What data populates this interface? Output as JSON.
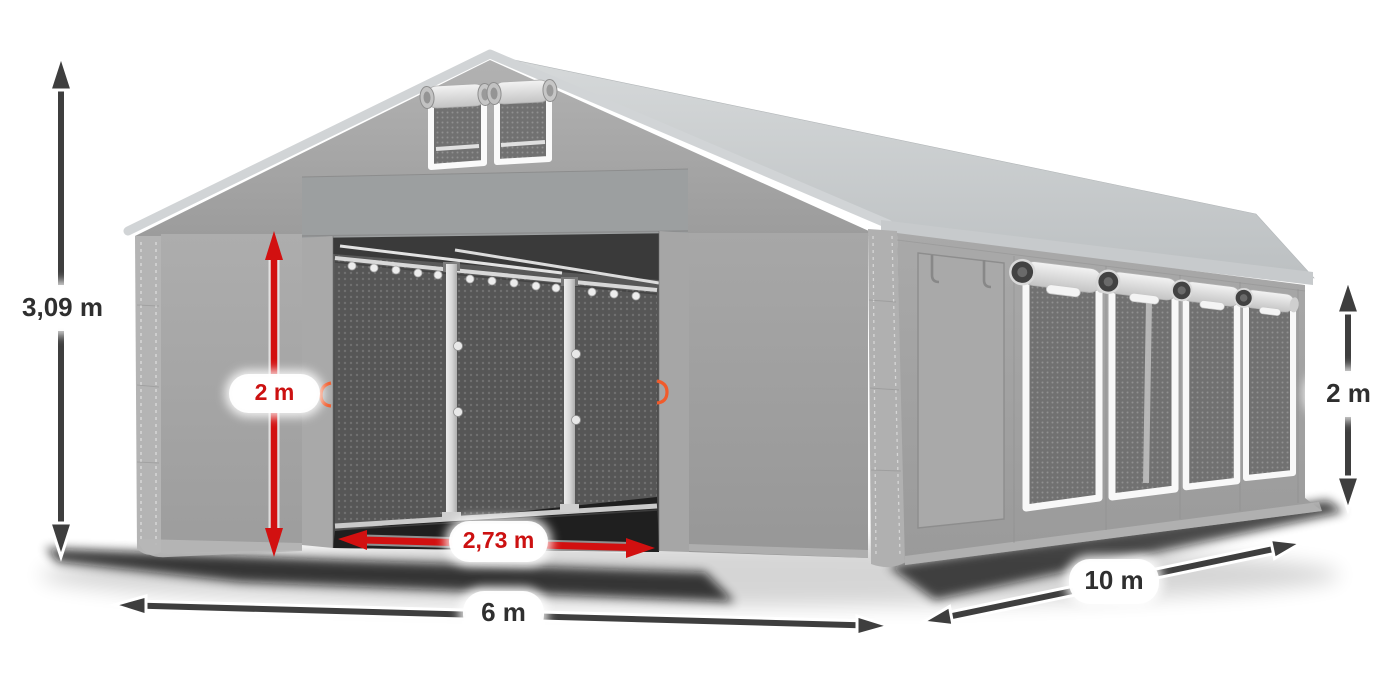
{
  "page": {
    "background": "#ffffff"
  },
  "diagram": {
    "subject": "gray-marquee-tent-dimension-diagram",
    "labels": {
      "total_height": {
        "text": "3,09 m",
        "color": "#2f2f2f"
      },
      "entrance_height": {
        "text": "2 m",
        "color": "#cc1111"
      },
      "entrance_width": {
        "text": "2,73 m",
        "color": "#cc1111"
      },
      "front_width": {
        "text": "6 m",
        "color": "#2f2f2f"
      },
      "side_length": {
        "text": "10 m",
        "color": "#2f2f2f"
      },
      "side_wall_height": {
        "text": "2 m",
        "color": "#2f2f2f"
      }
    },
    "arrow_colors": {
      "dark": "#3e3e3e",
      "red": "#d21010"
    },
    "label_style": {
      "background": "#ffffff"
    },
    "tent_colors": {
      "roof": "#c9cccd",
      "walls": "#a3a3a3",
      "interior": "#4f4f4f",
      "mesh": "#6f6f6f",
      "frame_trim": "#f8f8f8",
      "clip_accent": "#f15b2b"
    }
  }
}
